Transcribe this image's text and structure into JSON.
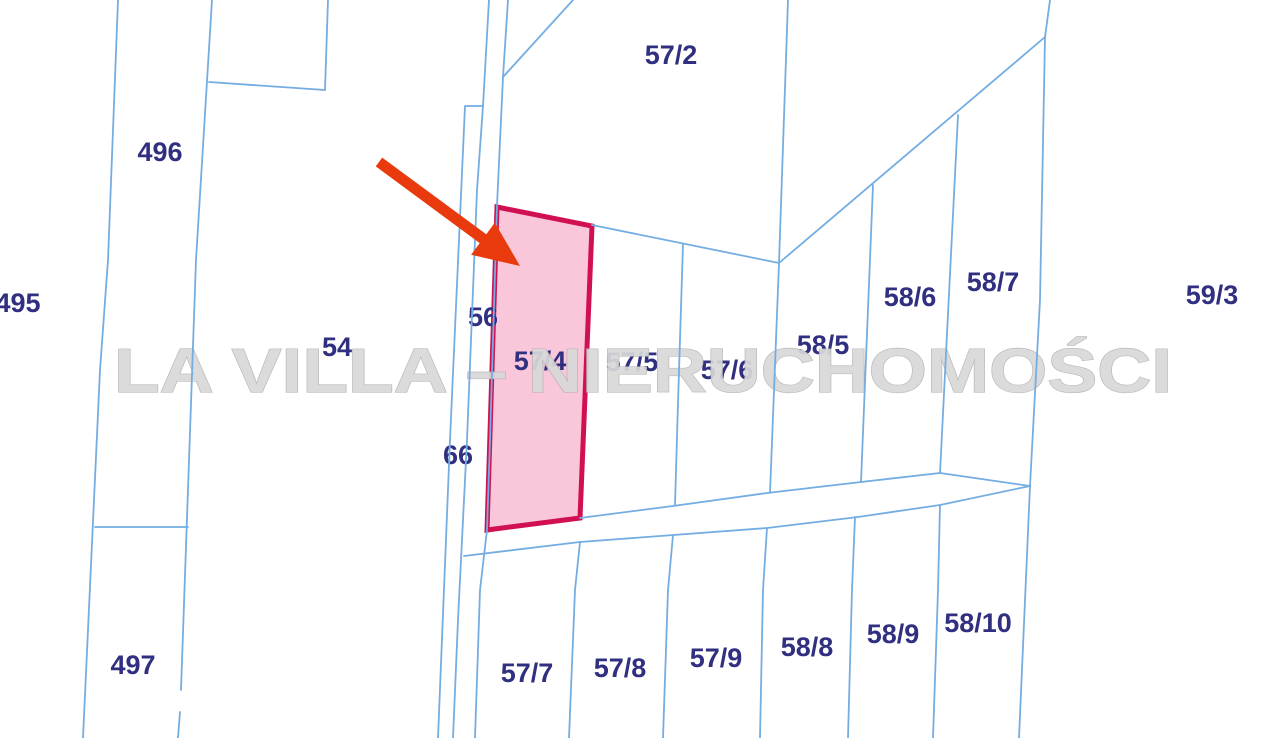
{
  "page": {
    "width": 1280,
    "height": 738,
    "background": "#ffffff"
  },
  "map": {
    "line_color": "#74ade2",
    "line_width": 1.8,
    "label_color": "#302f80",
    "label_font_size": 27,
    "boundary_lines": [
      {
        "id": "west-field-line",
        "points": [
          [
            118,
            0
          ],
          [
            108,
            260
          ],
          [
            100,
            370
          ],
          [
            83,
            738
          ]
        ]
      },
      {
        "id": "parcel-496-west-line",
        "points": [
          [
            212,
            0
          ],
          [
            196,
            260
          ],
          [
            181,
            690
          ]
        ]
      },
      {
        "id": "parcel-496-west-line-lower",
        "points": [
          [
            180,
            712
          ],
          [
            178,
            738
          ]
        ]
      },
      {
        "id": "notch-vertical",
        "points": [
          [
            328,
            0
          ],
          [
            325,
            90
          ]
        ]
      },
      {
        "id": "notch-horizontal",
        "points": [
          [
            325,
            90
          ],
          [
            209,
            82
          ]
        ]
      },
      {
        "id": "parcel-496-497-divider",
        "points": [
          [
            95,
            527
          ],
          [
            188,
            527
          ]
        ]
      },
      {
        "id": "road-66-west-line",
        "points": [
          [
            483,
            106
          ],
          [
            465,
            106
          ],
          [
            450,
            440
          ],
          [
            438,
            738
          ]
        ]
      },
      {
        "id": "road-66-east-line",
        "points": [
          [
            489,
            0
          ],
          [
            483,
            106
          ],
          [
            477,
            190
          ],
          [
            467,
            440
          ],
          [
            458,
            620
          ],
          [
            453,
            738
          ]
        ]
      },
      {
        "id": "road-56-east-line",
        "points": [
          [
            508,
            0
          ],
          [
            503,
            77
          ],
          [
            497,
            206
          ],
          [
            490,
            440
          ],
          [
            487,
            530
          ],
          [
            480,
            590
          ],
          [
            475,
            738
          ]
        ]
      },
      {
        "id": "parcel-57-2-west-diagonal",
        "points": [
          [
            573,
            0
          ],
          [
            503,
            77
          ]
        ]
      },
      {
        "id": "parcel-57-2-east-line",
        "points": [
          [
            788,
            0
          ],
          [
            779,
            263
          ],
          [
            770,
            493
          ]
        ]
      },
      {
        "id": "parcel-57-2-south-line",
        "points": [
          [
            592,
            225
          ],
          [
            779,
            263
          ]
        ]
      },
      {
        "id": "parcel-57-5-57-6-divider",
        "points": [
          [
            683,
            244
          ],
          [
            678,
            403
          ],
          [
            675,
            505
          ]
        ]
      },
      {
        "id": "parcel-58-north-diagonal",
        "points": [
          [
            779,
            263
          ],
          [
            1045,
            37
          ]
        ]
      },
      {
        "id": "parcel-58-5-58-6-divider",
        "points": [
          [
            873,
            185
          ],
          [
            861,
            482
          ]
        ]
      },
      {
        "id": "parcel-58-6-58-7-divider",
        "points": [
          [
            958,
            115
          ],
          [
            940,
            473
          ]
        ]
      },
      {
        "id": "east-boundary-line",
        "points": [
          [
            1050,
            0
          ],
          [
            1045,
            37
          ],
          [
            1040,
            300
          ],
          [
            1030,
            486
          ],
          [
            1019,
            738
          ]
        ]
      },
      {
        "id": "road-north-line",
        "points": [
          [
            580,
            518
          ],
          [
            673,
            506
          ],
          [
            767,
            493
          ],
          [
            861,
            482
          ],
          [
            940,
            473
          ],
          [
            1030,
            486
          ]
        ]
      },
      {
        "id": "road-south-line",
        "points": [
          [
            464,
            556
          ],
          [
            580,
            542
          ],
          [
            767,
            528
          ],
          [
            858,
            517
          ],
          [
            940,
            505
          ],
          [
            1030,
            486
          ]
        ]
      },
      {
        "id": "parcel-57-7-57-8-divider",
        "points": [
          [
            580,
            542
          ],
          [
            575,
            590
          ],
          [
            569,
            738
          ]
        ]
      },
      {
        "id": "parcel-57-8-57-9-divider",
        "points": [
          [
            673,
            535
          ],
          [
            668,
            590
          ],
          [
            663,
            738
          ]
        ]
      },
      {
        "id": "parcel-57-9-58-8-divider",
        "points": [
          [
            767,
            528
          ],
          [
            763,
            590
          ],
          [
            760,
            738
          ]
        ]
      },
      {
        "id": "parcel-58-8-58-9-divider",
        "points": [
          [
            855,
            517
          ],
          [
            852,
            590
          ],
          [
            848,
            738
          ]
        ]
      },
      {
        "id": "parcel-58-9-58-10-divider",
        "points": [
          [
            940,
            505
          ],
          [
            938,
            590
          ],
          [
            933,
            738
          ]
        ]
      }
    ],
    "labels": [
      {
        "text": "495",
        "x": 18,
        "y": 303
      },
      {
        "text": "496",
        "x": 160,
        "y": 152
      },
      {
        "text": "497",
        "x": 133,
        "y": 665
      },
      {
        "text": "54",
        "x": 337,
        "y": 347
      },
      {
        "text": "56",
        "x": 483,
        "y": 317
      },
      {
        "text": "66",
        "x": 458,
        "y": 455
      },
      {
        "text": "57/2",
        "x": 671,
        "y": 55
      },
      {
        "text": "57/4",
        "x": 540,
        "y": 361
      },
      {
        "text": "57/5",
        "x": 632,
        "y": 362
      },
      {
        "text": "57/6",
        "x": 727,
        "y": 370
      },
      {
        "text": "58/5",
        "x": 823,
        "y": 345
      },
      {
        "text": "58/6",
        "x": 910,
        "y": 297
      },
      {
        "text": "58/7",
        "x": 993,
        "y": 282
      },
      {
        "text": "59/3",
        "x": 1212,
        "y": 295
      },
      {
        "text": "57/7",
        "x": 527,
        "y": 673
      },
      {
        "text": "57/8",
        "x": 620,
        "y": 668
      },
      {
        "text": "57/9",
        "x": 716,
        "y": 658
      },
      {
        "text": "58/8",
        "x": 807,
        "y": 647
      },
      {
        "text": "58/9",
        "x": 893,
        "y": 634
      },
      {
        "text": "58/10",
        "x": 978,
        "y": 623
      }
    ]
  },
  "highlight_parcel": {
    "label": "57/4",
    "points": [
      [
        497,
        207
      ],
      [
        592,
        226
      ],
      [
        580,
        518
      ],
      [
        487,
        530
      ]
    ],
    "fill": "#f9c6da",
    "stroke": "#d01052",
    "stroke_width": 5
  },
  "arrow": {
    "tail": [
      379,
      162
    ],
    "tip": [
      520,
      266
    ],
    "color": "#e93a0e",
    "shaft_width": 11,
    "head_length": 46,
    "head_width": 40
  },
  "watermark": {
    "text": "LA VILLA – NIERUCHOMOŚCI",
    "color": "#d9d9d9",
    "outline_color": "#b6b6b6",
    "x": 643,
    "y": 392,
    "font_size": 62,
    "text_length": 1058
  }
}
